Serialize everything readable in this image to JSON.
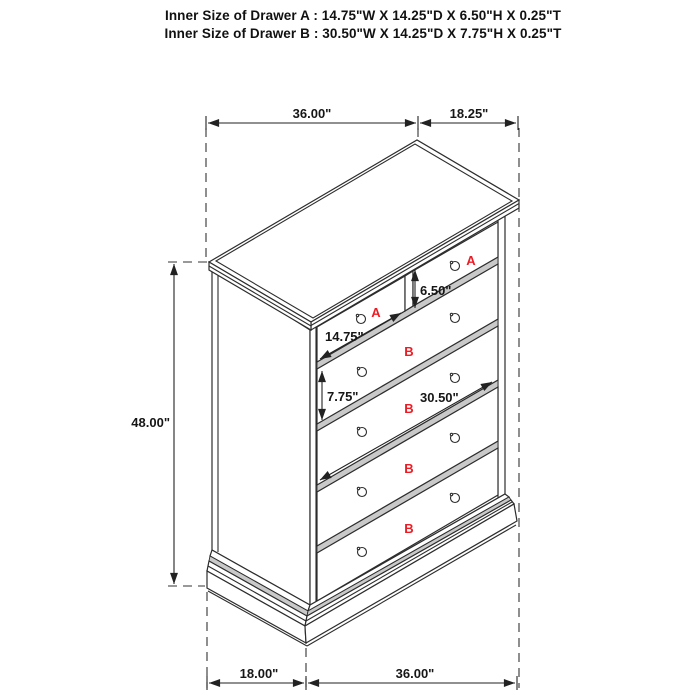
{
  "header": {
    "drawer_a_line": "Inner Size of Drawer A : 14.75\"W X 14.25\"D X 6.50\"H X 0.25\"T",
    "drawer_b_line": "Inner Size of Drawer B : 30.50\"W X 14.25\"D X 7.75\"H X 0.25\"T"
  },
  "dimensions": {
    "top_width": "36.00\"",
    "top_depth": "18.25\"",
    "overall_height": "48.00\"",
    "bottom_depth": "18.00\"",
    "bottom_width": "36.00\"",
    "drawer_a_width": "14.75\"",
    "drawer_a_height": "6.50\"",
    "drawer_b_height": "7.75\"",
    "drawer_b_width": "30.50\""
  },
  "drawer_labels": {
    "a": "A",
    "b": "B"
  },
  "colors": {
    "line": "#2d2d2d",
    "dimension_text": "#161616",
    "label_red": "#ed1c24",
    "gap_band_gray": "#c9c9c9",
    "background": "#ffffff"
  }
}
